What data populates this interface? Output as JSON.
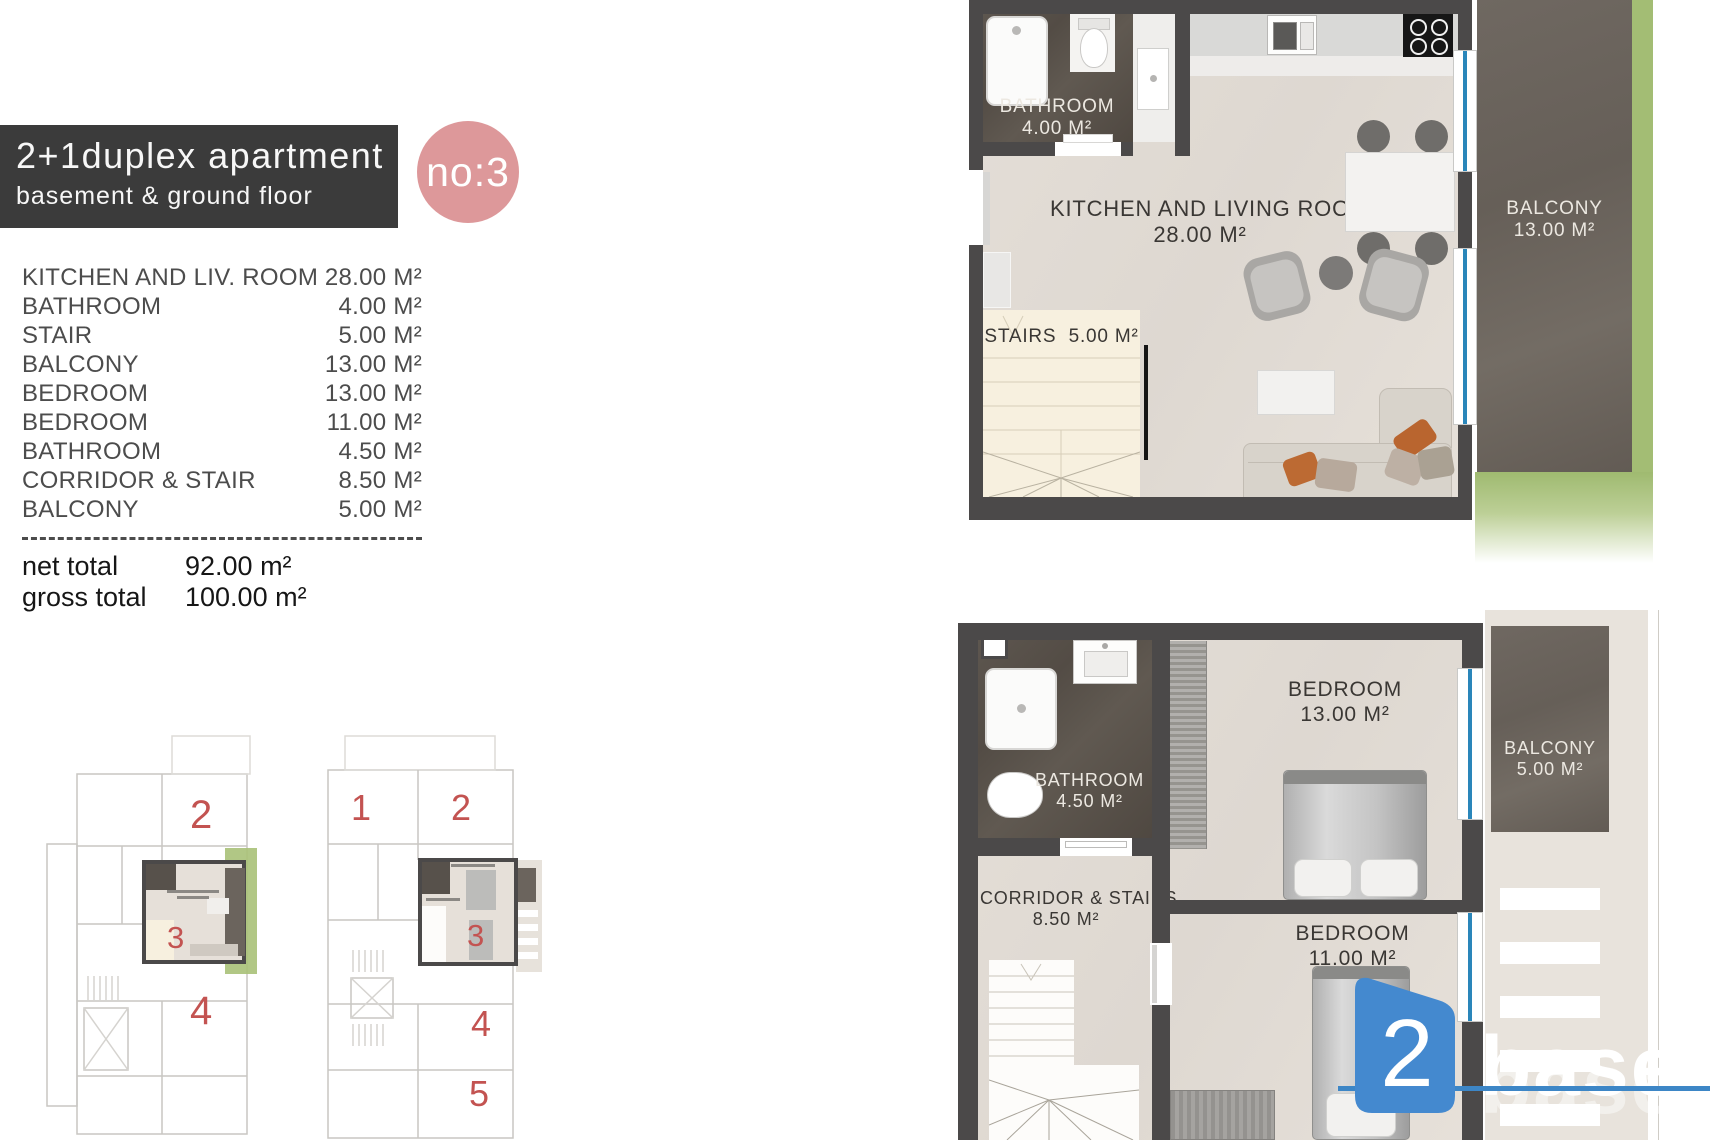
{
  "header": {
    "title": "2+1duplex apartment",
    "subtitle": "basement & ground floor",
    "badge": "no:3"
  },
  "room_list": [
    {
      "name": "KITCHEN AND LIV. ROOM",
      "area": "28.00 M²"
    },
    {
      "name": "BATHROOM",
      "area": "4.00 M²"
    },
    {
      "name": "STAIR",
      "area": "5.00 M²"
    },
    {
      "name": "BALCONY",
      "area": "13.00 M²"
    },
    {
      "name": "BEDROOM",
      "area": "13.00 M²"
    },
    {
      "name": "BEDROOM",
      "area": "11.00 M²"
    },
    {
      "name": "BATHROOM",
      "area": "4.50 M²"
    },
    {
      "name": "CORRIDOR & STAIR",
      "area": "8.50 M²"
    },
    {
      "name": "BALCONY",
      "area": "5.00 M²"
    }
  ],
  "totals": {
    "net_label": "net total",
    "net_value": "92.00 m²",
    "gross_label": "gross total",
    "gross_value": "100.00 m²"
  },
  "ground_plan": {
    "kitchen_living": {
      "name": "KITCHEN AND LIVING ROOM",
      "area": "28.00 M²"
    },
    "bathroom": {
      "name": "BATHROOM",
      "area": "4.00 M²"
    },
    "stairs": {
      "name": "STAIRS",
      "area": "5.00 M²"
    },
    "balcony": {
      "name": "BALCONY",
      "area": "13.00 M²"
    }
  },
  "basement_plan": {
    "bathroom": {
      "name": "BATHROOM",
      "area": "4.50 M²"
    },
    "bedroom_large": {
      "name": "BEDROOM",
      "area": "13.00 M²"
    },
    "corridor": {
      "name": "CORRIDOR & STAIRS",
      "area": "8.50 M²"
    },
    "bedroom_small": {
      "name": "BEDROOM",
      "area": "11.00 M²"
    },
    "balcony": {
      "name": "BALCONY",
      "area": "5.00 M²"
    }
  },
  "overview": {
    "ground": {
      "numbers": [
        "2",
        "3",
        "4"
      ]
    },
    "basement": {
      "numbers": [
        "1",
        "2",
        "3",
        "4",
        "5"
      ]
    }
  },
  "watermark": {
    "badge_number": "2",
    "brand_text": "base"
  },
  "colors": {
    "banner_bg": "#3b3b3b",
    "badge_pink": "#dd989a",
    "wall": "#4b4949",
    "floor_beige": "#e2dcd5",
    "stone_dark": "#57514b",
    "stone_balcony": "#6b645d",
    "stairs_cream": "#f7f0df",
    "green": "#a3bd74",
    "window_blue": "#2a86ba",
    "logo_blue": "#4489cf",
    "unit_number_red": "#c35351"
  }
}
